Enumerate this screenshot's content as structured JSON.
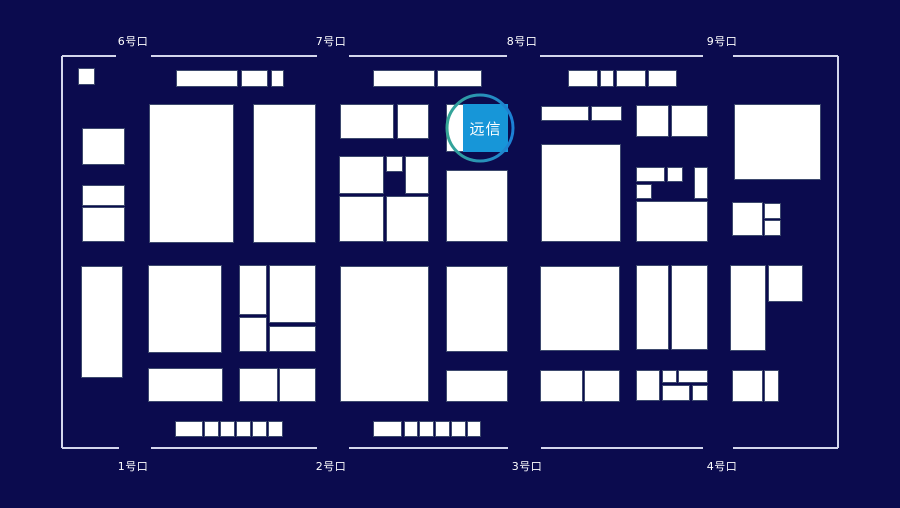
{
  "canvas": {
    "width": 900,
    "height": 508,
    "background": "#0B0B4E"
  },
  "map": {
    "border_color": "#D4D6EC",
    "border_width": 2,
    "outline": {
      "left": 62,
      "top": 56,
      "right": 838,
      "bottom": 448
    },
    "top_segments": [
      [
        62,
        116
      ],
      [
        151,
        317
      ],
      [
        349,
        507
      ],
      [
        540,
        703
      ],
      [
        733,
        838
      ]
    ],
    "bottom_segments": [
      [
        62,
        119
      ],
      [
        151,
        317
      ],
      [
        349,
        508
      ],
      [
        541,
        703
      ],
      [
        733,
        838
      ]
    ],
    "booth_fill": "#FFFFFF",
    "booth_stroke": "#3E4A6E",
    "booths": [
      [
        78,
        68,
        17,
        17
      ],
      [
        82,
        128,
        43,
        37
      ],
      [
        82,
        185,
        43,
        21
      ],
      [
        82,
        207,
        43,
        35
      ],
      [
        149,
        104,
        85,
        139
      ],
      [
        253,
        104,
        63,
        139
      ],
      [
        176,
        70,
        62,
        17
      ],
      [
        241,
        70,
        27,
        17
      ],
      [
        271,
        70,
        13,
        17
      ],
      [
        373,
        70,
        62,
        17
      ],
      [
        437,
        70,
        45,
        17
      ],
      [
        568,
        70,
        30,
        17
      ],
      [
        600,
        70,
        14,
        17
      ],
      [
        616,
        70,
        30,
        17
      ],
      [
        648,
        70,
        29,
        17
      ],
      [
        340,
        104,
        54,
        35
      ],
      [
        397,
        104,
        32,
        35
      ],
      [
        339,
        156,
        45,
        38
      ],
      [
        386,
        156,
        17,
        16
      ],
      [
        405,
        156,
        24,
        38
      ],
      [
        339,
        196,
        45,
        46
      ],
      [
        386,
        196,
        43,
        46
      ],
      [
        446,
        104,
        62,
        48
      ],
      [
        446,
        170,
        62,
        72
      ],
      [
        541,
        106,
        48,
        15
      ],
      [
        591,
        106,
        31,
        15
      ],
      [
        541,
        144,
        80,
        98
      ],
      [
        636,
        105,
        33,
        32
      ],
      [
        671,
        105,
        37,
        32
      ],
      [
        636,
        167,
        29,
        15
      ],
      [
        667,
        167,
        16,
        15
      ],
      [
        694,
        167,
        14,
        32
      ],
      [
        636,
        184,
        16,
        15
      ],
      [
        636,
        201,
        72,
        41
      ],
      [
        734,
        104,
        87,
        76
      ],
      [
        732,
        202,
        31,
        34
      ],
      [
        764,
        203,
        17,
        16
      ],
      [
        764,
        220,
        17,
        16
      ],
      [
        81,
        266,
        42,
        112
      ],
      [
        148,
        265,
        74,
        88
      ],
      [
        148,
        368,
        75,
        34
      ],
      [
        239,
        265,
        28,
        50
      ],
      [
        269,
        265,
        47,
        58
      ],
      [
        239,
        317,
        28,
        35
      ],
      [
        269,
        326,
        47,
        26
      ],
      [
        239,
        368,
        39,
        34
      ],
      [
        279,
        368,
        37,
        34
      ],
      [
        340,
        266,
        89,
        136
      ],
      [
        446,
        266,
        62,
        86
      ],
      [
        446,
        370,
        62,
        32
      ],
      [
        540,
        266,
        80,
        85
      ],
      [
        540,
        370,
        43,
        32
      ],
      [
        584,
        370,
        36,
        32
      ],
      [
        636,
        265,
        33,
        85
      ],
      [
        671,
        265,
        37,
        85
      ],
      [
        636,
        370,
        24,
        31
      ],
      [
        662,
        370,
        15,
        13
      ],
      [
        678,
        370,
        30,
        13
      ],
      [
        662,
        385,
        28,
        16
      ],
      [
        692,
        385,
        16,
        16
      ],
      [
        730,
        265,
        36,
        86
      ],
      [
        768,
        265,
        35,
        37
      ],
      [
        732,
        370,
        31,
        32
      ],
      [
        764,
        370,
        15,
        32
      ],
      [
        175,
        421,
        28,
        16
      ],
      [
        204,
        421,
        15,
        16
      ],
      [
        220,
        421,
        15,
        16
      ],
      [
        236,
        421,
        15,
        16
      ],
      [
        252,
        421,
        15,
        16
      ],
      [
        268,
        421,
        15,
        16
      ],
      [
        373,
        421,
        29,
        16
      ],
      [
        404,
        421,
        14,
        16
      ],
      [
        419,
        421,
        15,
        16
      ],
      [
        435,
        421,
        15,
        16
      ],
      [
        451,
        421,
        15,
        16
      ],
      [
        467,
        421,
        14,
        16
      ]
    ]
  },
  "gates": {
    "top_y": 36,
    "bottom_y": 461,
    "top": [
      {
        "label": "6号口",
        "cx": 133
      },
      {
        "label": "7号口",
        "cx": 331
      },
      {
        "label": "8号口",
        "cx": 522
      },
      {
        "label": "9号口",
        "cx": 722
      }
    ],
    "bottom": [
      {
        "label": "1号口",
        "cx": 133
      },
      {
        "label": "2号口",
        "cx": 331
      },
      {
        "label": "3号口",
        "cx": 527
      },
      {
        "label": "4号口",
        "cx": 722
      }
    ]
  },
  "highlight": {
    "label": "远信",
    "box": {
      "x": 463,
      "y": 104,
      "w": 45,
      "h": 48
    },
    "box_color": "#1796D8",
    "text_color": "#FFFFFF",
    "ring": {
      "cx": 480,
      "cy": 128,
      "r": 33,
      "width": 3,
      "color_left": "#35A695",
      "color_right": "#1C80D6"
    }
  }
}
